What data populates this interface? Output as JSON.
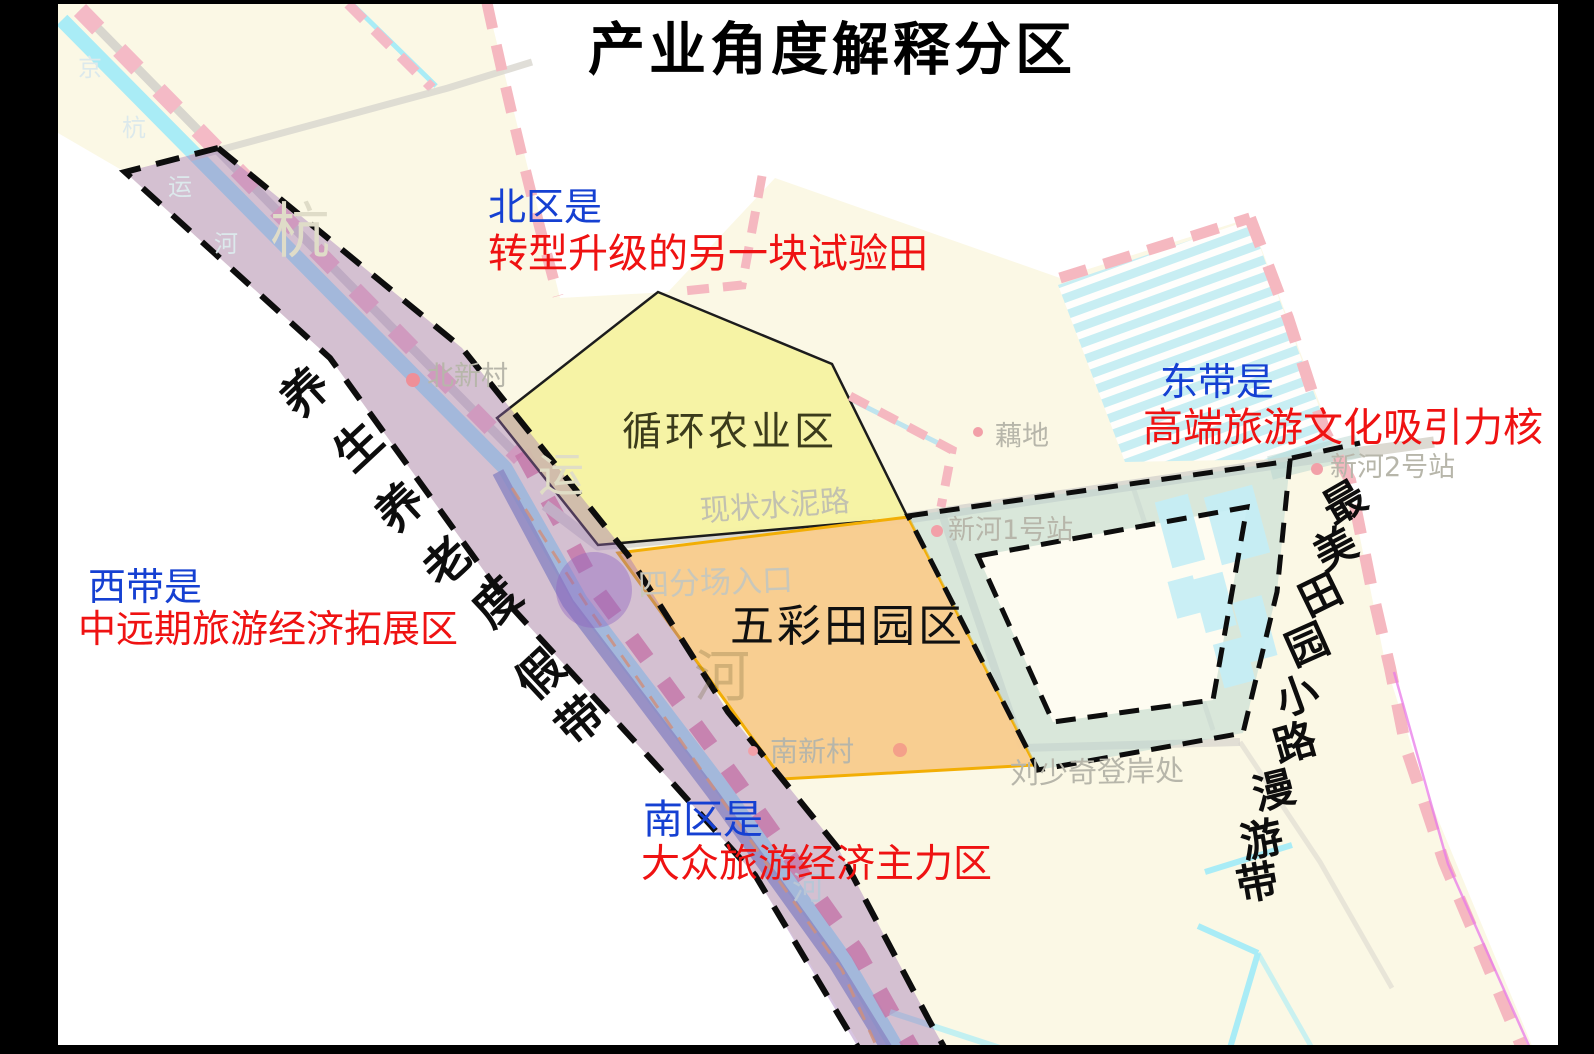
{
  "title": "产业角度解释分区",
  "annotations": {
    "north": {
      "zone": "北区是",
      "desc": "转型升级的另一块试验田"
    },
    "west": {
      "zone": "西带是",
      "desc": "中远期旅游经济拓展区"
    },
    "east": {
      "zone": "东带是",
      "desc": "高端旅游文化吸引力核"
    },
    "south": {
      "zone": "南区是",
      "desc": "大众旅游经济主力区"
    }
  },
  "zones": {
    "agriculture": "循环农业区",
    "pastoral": "五彩田园区"
  },
  "belts": {
    "west_belt": "养生养老度假带",
    "east_belt": "最美田园小路漫游带"
  },
  "map_labels": {
    "beixincun": "北新村",
    "cement_road": "现状水泥路",
    "sifenchang": "四分场入口",
    "oudi": "藕地",
    "xinhe2": "新河2号站",
    "xinhe1": "新河1号站",
    "nanxincun": "南新村",
    "liushaoqi": "刘少奇登岸处"
  },
  "watermarks": {
    "c1": "京",
    "c2": "杭",
    "c3": "运",
    "c4": "河",
    "big1": "杭",
    "big2": "运",
    "big3": "河",
    "small1": "河"
  },
  "colors": {
    "annotation_zone": "#1540d2",
    "annotation_desc": "#ef1212",
    "agriculture_fill": "#f6f2a2",
    "pastoral_fill": "#f8cc8e",
    "pastoral_border": "#f2ae05",
    "belt_purple": "#9a6cb4",
    "boundary_pink": "#f5b8c0",
    "canal_cyan": "#a9ecf6",
    "loop_teal": "#b7d6d0",
    "base_cream": "#fbf8e5"
  }
}
